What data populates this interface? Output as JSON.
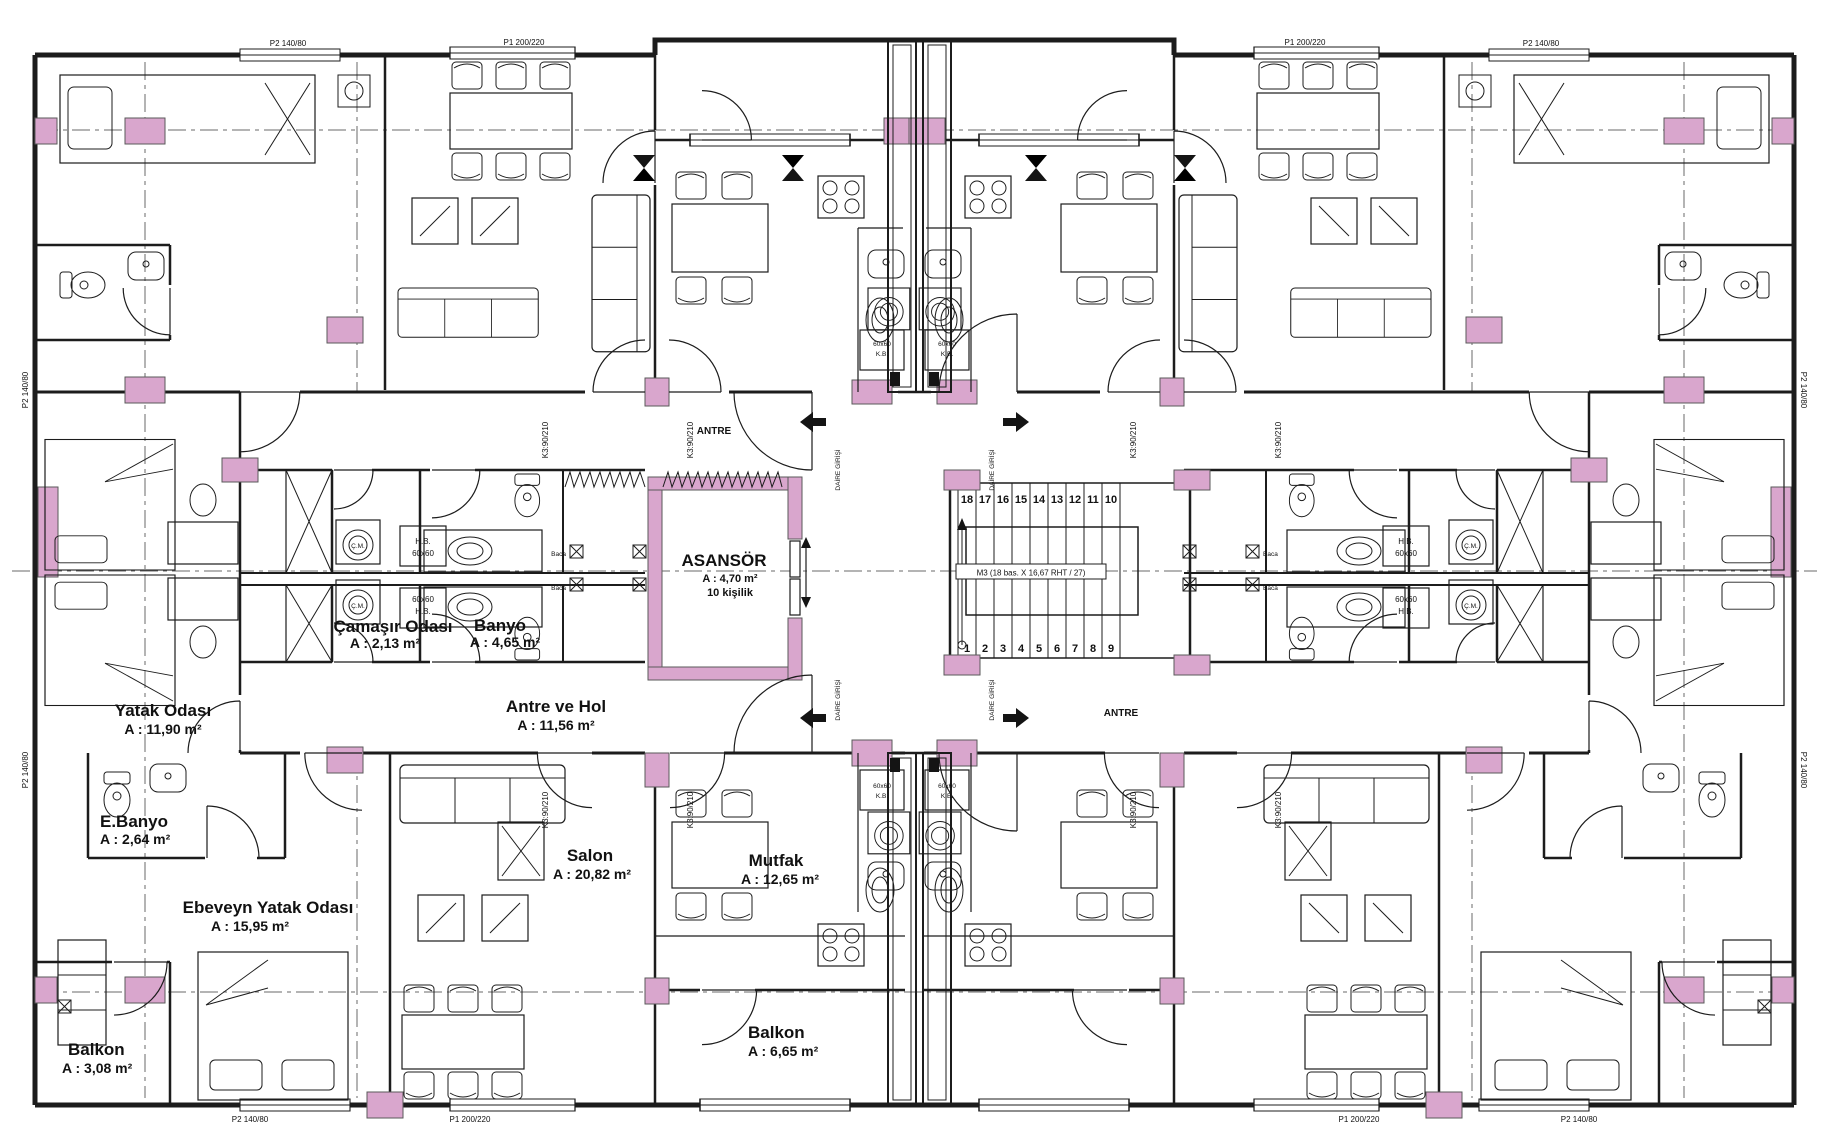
{
  "plan": {
    "colors": {
      "column": "#D9A6CD",
      "wall": "#1C1C1C",
      "background": "#FFFFFF"
    },
    "rooms": {
      "yatak_odasi": {
        "name": "Yatak Odası",
        "area": "A : 11,90 m²"
      },
      "camasir_odasi": {
        "name": "Çamaşır Odası",
        "area": "A : 2,13 m²"
      },
      "banyo": {
        "name": "Banyo",
        "area": "A : 4,65 m²"
      },
      "asansor": {
        "name": "ASANSÖR",
        "area": "A : 4,70 m²",
        "capacity": "10 kişilik"
      },
      "antre_ve_hol": {
        "name": "Antre ve Hol",
        "area": "A : 11,56 m²"
      },
      "e_banyo": {
        "name": "E.Banyo",
        "area": "A : 2,64 m²"
      },
      "ebeveyn_yatak_odasi": {
        "name": "Ebeveyn Yatak Odası",
        "area": "A : 15,95 m²"
      },
      "salon": {
        "name": "Salon",
        "area": "A : 20,82 m²"
      },
      "mutfak": {
        "name": "Mutfak",
        "area": "A : 12,65 m²"
      },
      "balkon_kose": {
        "name": "Balkon",
        "area": "A : 3,08 m²"
      },
      "balkon_orta": {
        "name": "Balkon",
        "area": "A : 6,65 m²"
      },
      "antre_ust": "ANTRE",
      "antre_sag": "ANTRE"
    },
    "stairs": {
      "label": "M3 (18 bas. X 16,67 RHT / 27)",
      "upper": [
        "18",
        "17",
        "16",
        "15",
        "14",
        "13",
        "12",
        "11",
        "10"
      ],
      "lower": [
        "1",
        "2",
        "3",
        "4",
        "5",
        "6",
        "7",
        "8",
        "9"
      ]
    },
    "tags": {
      "k3": "K3:90/210",
      "p1": "P1 200/220",
      "p2": "P2 140/80",
      "hb": "H.B.",
      "s60": "60x60",
      "kb": "K.B.",
      "cm": "Ç.M.",
      "baca": "Baca",
      "giris": "DAİRE GİRİŞİ"
    }
  }
}
